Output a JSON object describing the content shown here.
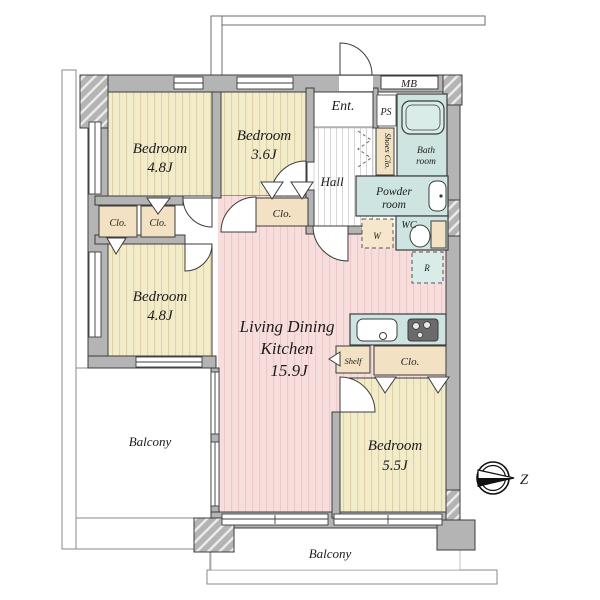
{
  "plan": {
    "bedrooms": [
      {
        "label": "Bedroom",
        "size": "4.8J"
      },
      {
        "label": "Bedroom",
        "size": "3.6J"
      },
      {
        "label": "Bedroom",
        "size": "4.8J"
      },
      {
        "label": "Bedroom",
        "size": "5.5J"
      }
    ],
    "ldk": {
      "line1": "Living Dining",
      "line2": "Kitchen",
      "size": "15.9J"
    },
    "entrance_label": "Ent.",
    "hall_label": "Hall",
    "bath": {
      "line1": "Bath",
      "line2": "room"
    },
    "powder": {
      "line1": "Powder",
      "line2": "room"
    },
    "wc_label": "WC",
    "balconies": {
      "left": "Balcony",
      "bottom": "Balcony"
    },
    "closets": {
      "clo_a": "Clo.",
      "clo_b": "Clo.",
      "clo_c": "Clo.",
      "clo_d": "Clo.",
      "shoes": "Shoes Clo.",
      "shelf": "Shelf"
    },
    "utilities": {
      "mb": "MB",
      "ps": "PS",
      "washer": "W",
      "fridge": "R"
    },
    "compass_label": "Z",
    "colors": {
      "bedroom_floor": "#f3ecca",
      "ldk_floor": "#f8dddd",
      "wet_area": "#cde4e0",
      "closet": "#f3e1c4",
      "wall": "#b4b4b4"
    }
  }
}
